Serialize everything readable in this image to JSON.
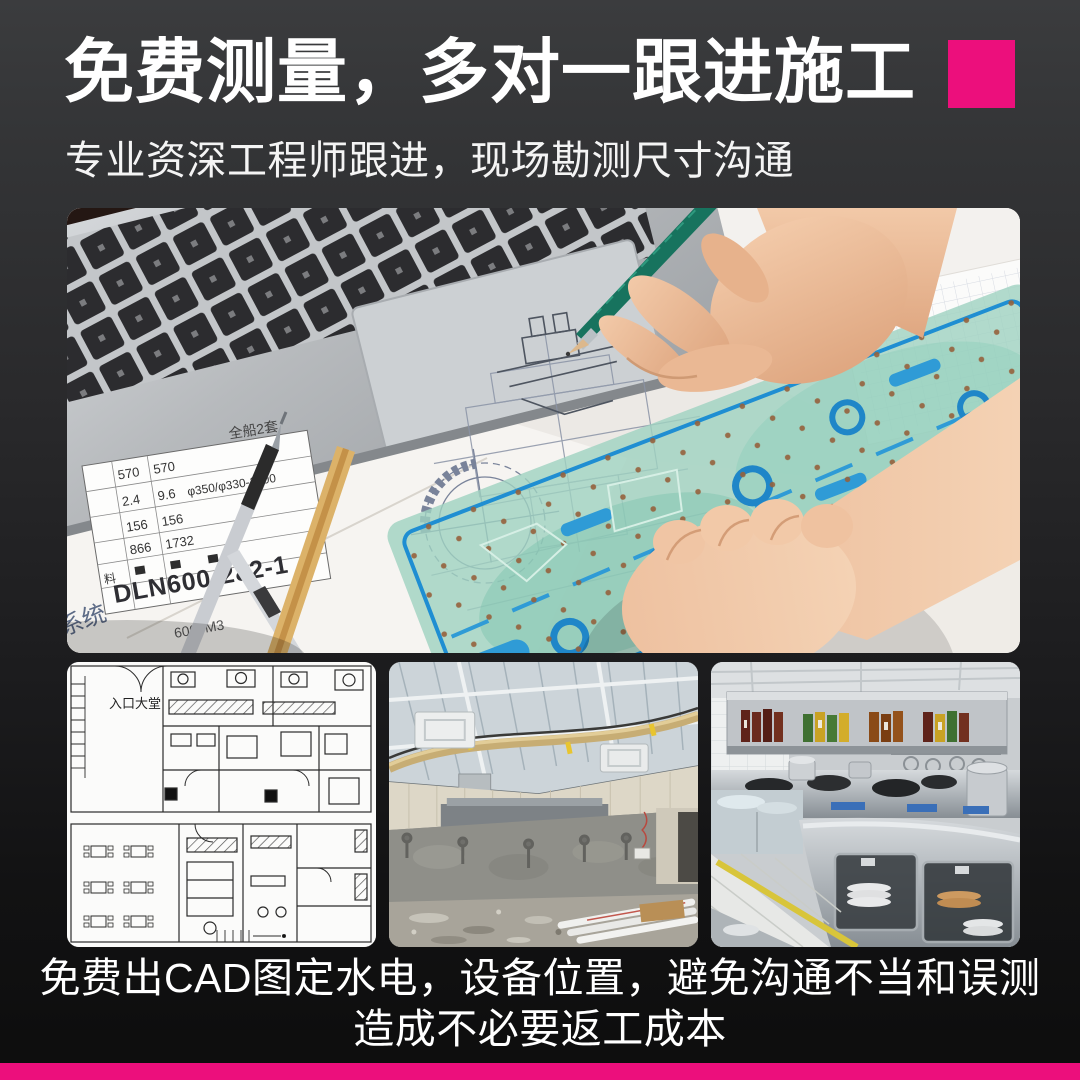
{
  "colors": {
    "accent": "#ec0f7c",
    "background_top": "#3b3c3e",
    "background_bottom": "#0d0d0d",
    "text": "#ffffff"
  },
  "header": {
    "title": "免费测量，多对一跟进施工",
    "subtitle": "专业资深工程师跟进，现场勘测尺寸沟通"
  },
  "caption": {
    "line1": "免费出CAD图定水电，设备位置，避免沟通不当和误测",
    "line2": "造成不必要返工成本"
  },
  "hero": {
    "paper": {
      "set_label": "全船2套",
      "rows": [
        [
          "570",
          "570"
        ],
        [
          "2.4",
          "9.6"
        ],
        [
          "156",
          "156"
        ],
        [
          "866",
          "1732"
        ]
      ],
      "spec": "φ350/φ330-1500",
      "material": "料",
      "code": "DLN600-282-1",
      "volume": "6000M3",
      "system": "系统"
    }
  },
  "thumbs": {
    "floorplan": {
      "label": "入口大堂"
    }
  }
}
